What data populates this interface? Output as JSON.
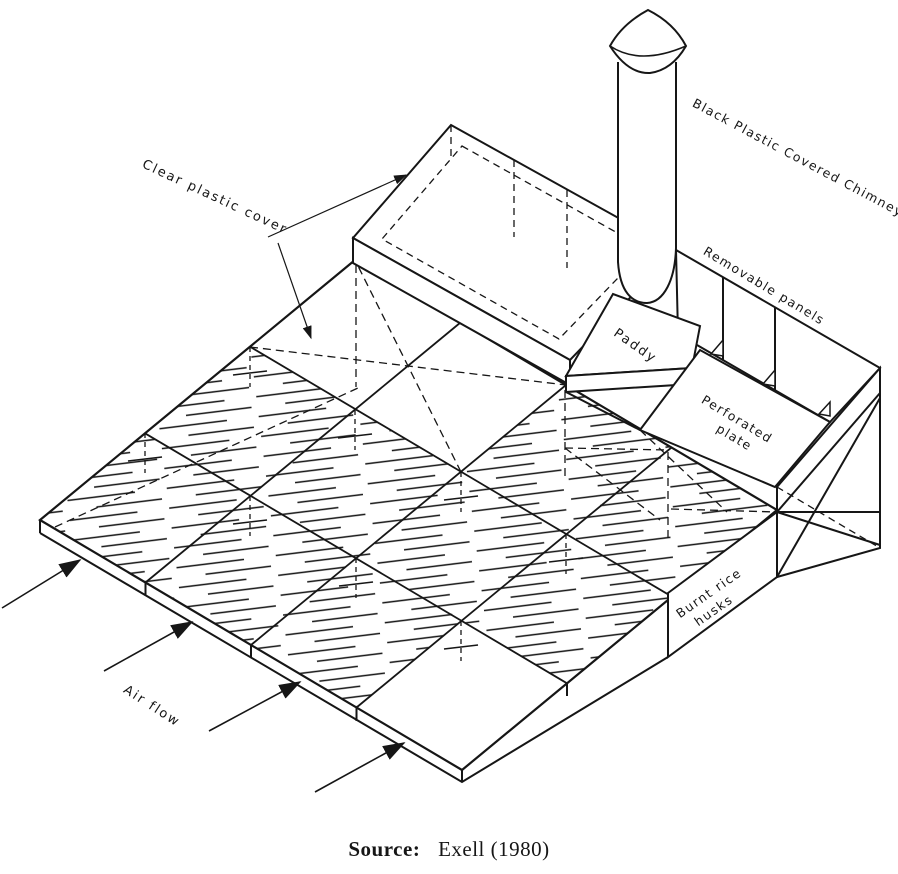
{
  "figure": {
    "labels": {
      "clear_plastic_cover": "Clear plastic cover",
      "black_plastic_chimney": "Black Plastic Covered Chimney",
      "removable_panels": "Removable panels",
      "paddy": "Paddy",
      "perforated_plate_line1": "Perforated",
      "perforated_plate_line2": "plate",
      "burnt_rice_husks_line1": "Burnt rice",
      "burnt_rice_husks_line2": "husks",
      "air_flow": "Air flow"
    },
    "caption": {
      "source_label": "Source:",
      "source_text": "Exell (1980)"
    },
    "colors": {
      "ink": "#161616",
      "paper": "#ffffff"
    }
  }
}
